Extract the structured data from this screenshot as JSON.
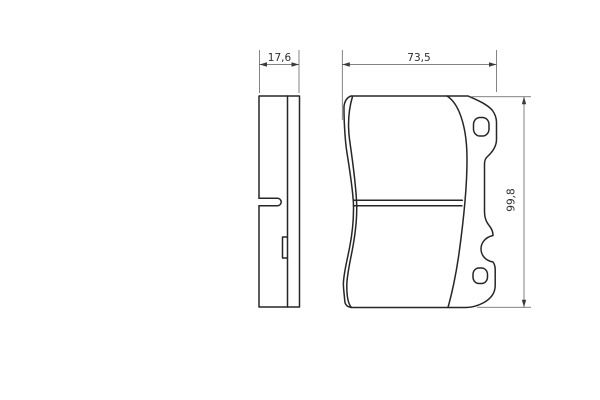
{
  "drawing": {
    "type": "technical-drawing-brake-pad",
    "views": {
      "side_view": "pad side profile",
      "front_view": "pad front face with mounting ears"
    },
    "dimensions": {
      "side_width": "17,6",
      "front_width": "73,5",
      "front_height": "99,8"
    },
    "colors": {
      "outline": "#262626",
      "dimension_lines": "#5a5a5a",
      "label_text": "#2e2e2e",
      "background": "#ffffff"
    }
  }
}
